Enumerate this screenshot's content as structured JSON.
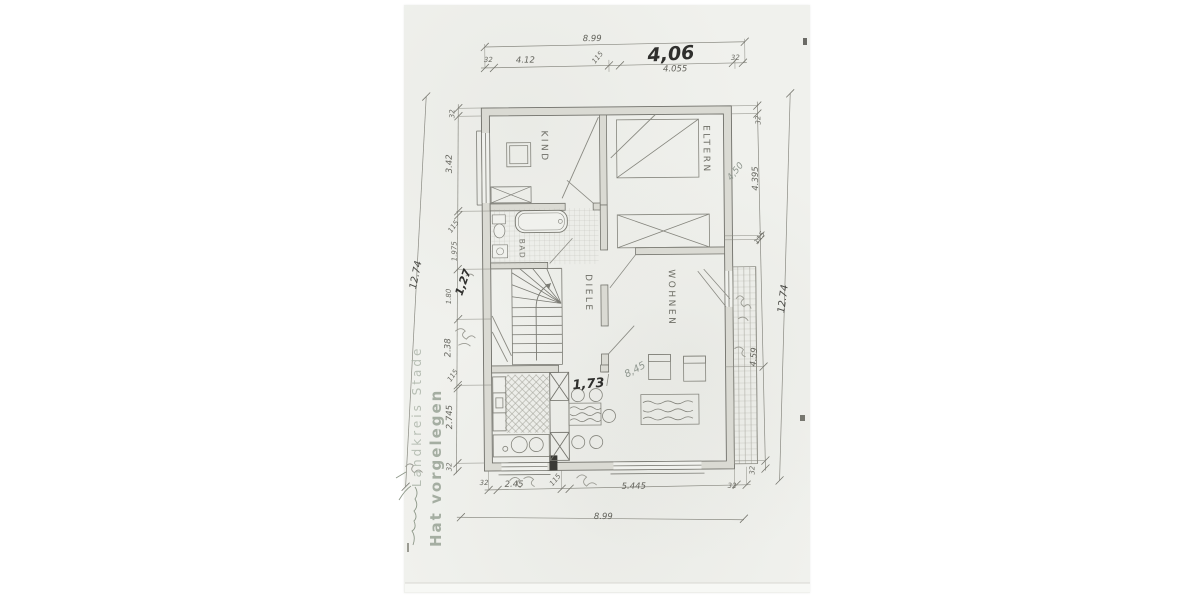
{
  "colors": {
    "paper": "#f0f1ed",
    "ink": "#55554f",
    "handwriting": "#2f2f2d",
    "stamp": "#9aa79a"
  },
  "stamp": {
    "authority": "Landkreis Stade",
    "note": "Hat vorgelegen"
  },
  "rooms": {
    "kind": "KIND",
    "eltern": "ELTERN",
    "bad": "BAD",
    "diele": "DIELE",
    "wohnen": "WOHNEN"
  },
  "dimensions": {
    "top": {
      "overall": "8.99",
      "wall_left": "32",
      "segment_left": "4.12",
      "wall_mid": "115",
      "segment_right": "4.055",
      "wall_right": "32"
    },
    "bottom": {
      "overall": "8.99",
      "wall_left": "32",
      "segment_left": "2.45",
      "wall_mid": "115",
      "segment_right": "5.445",
      "wall_right": "32"
    },
    "left": {
      "overall": "12.74",
      "wall_top": "32",
      "seg1": "3.42",
      "t1": "115",
      "seg2": "1.975",
      "seg3": "1.80",
      "seg4": "2.38",
      "t2": "115",
      "seg5": "2.745",
      "wall_bottom": "32"
    },
    "right": {
      "overall": "12.74",
      "wall_top": "32",
      "seg1": "4.395",
      "t1": "115",
      "seg2": "4.59",
      "wall_bottom": "32"
    }
  },
  "handwritten": {
    "top_total": "4,06",
    "hall_width": "1,73",
    "wohnen_note": "8,45",
    "left_note": "1,27",
    "right_note": "4,50"
  }
}
